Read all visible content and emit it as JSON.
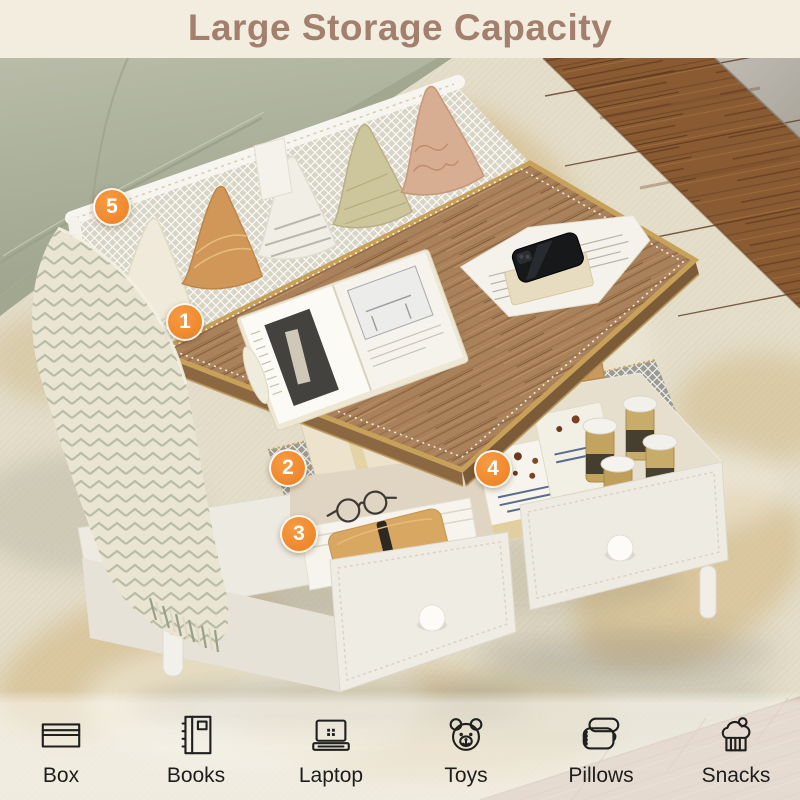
{
  "banner": {
    "title": "Large Storage Capacity"
  },
  "badges": {
    "accent_color": "#F0832A",
    "items": [
      {
        "number": "1"
      },
      {
        "number": "2"
      },
      {
        "number": "3"
      },
      {
        "number": "4"
      },
      {
        "number": "5"
      }
    ]
  },
  "legend": {
    "items": [
      {
        "icon": "box-icon",
        "label": "Box"
      },
      {
        "icon": "books-icon",
        "label": "Books"
      },
      {
        "icon": "laptop-icon",
        "label": "Laptop"
      },
      {
        "icon": "toys-icon",
        "label": "Toys"
      },
      {
        "icon": "pillows-icon",
        "label": "Pillows"
      },
      {
        "icon": "snacks-icon",
        "label": "Snacks"
      }
    ]
  },
  "scene": {
    "colors": {
      "banner_bg": "#F2EDDE",
      "banner_text": "#A3806E",
      "badge_orange": "#F0832A",
      "rug": "#E4DDC9",
      "sofa_green": "#AEB39E",
      "floor_wood_dark": "#8A5B33",
      "floor_wood_light": "#C9B2A1",
      "tabletop_wood": "#A8815A",
      "table_white": "#F3F1EA",
      "brass_trim": "#C7A159"
    }
  }
}
